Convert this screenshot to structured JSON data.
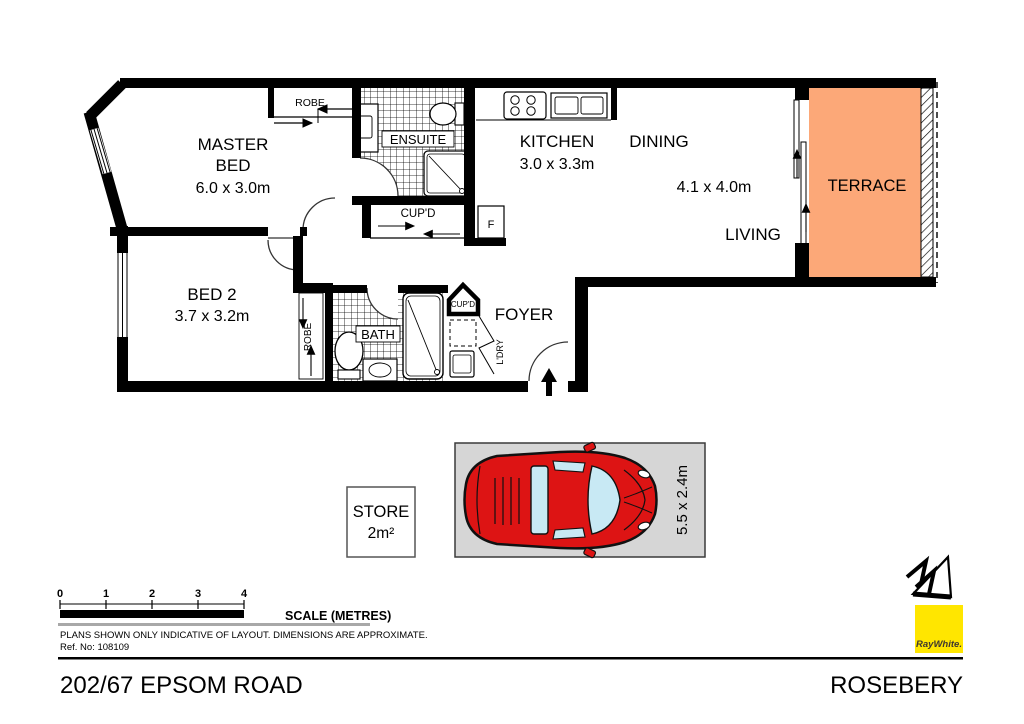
{
  "colors": {
    "terrace": "#FCA878",
    "car_body": "#DD1414",
    "car_glass": "#C8E9F4",
    "car_space_bg": "#D6D6D6",
    "brand_yellow": "#FFE600",
    "scale_gray": "#A8A8A8"
  },
  "floorplan": {
    "rooms": {
      "master_bed": {
        "line1": "MASTER",
        "line2": "BED",
        "dims": "6.0 x 3.0m"
      },
      "bed2": {
        "name": "BED 2",
        "dims": "3.7 x 3.2m"
      },
      "kitchen": {
        "name": "KITCHEN",
        "dims": "3.0 x 3.3m"
      },
      "dining": {
        "name": "DINING"
      },
      "living": {
        "name": "LIVING"
      },
      "living_dining_dims": "4.1 x 4.0m",
      "terrace": {
        "name": "TERRACE"
      },
      "foyer": {
        "name": "FOYER"
      },
      "ensuite": {
        "name": "ENSUITE"
      },
      "bath": {
        "name": "BATH"
      },
      "robe_master": "ROBE",
      "robe_bed2": "ROBE",
      "cupd_hall": "CUP'D",
      "cupd_foyer": "CUP'D",
      "laundry": "L'DRY",
      "fridge": "F"
    },
    "store": {
      "line1": "STORE",
      "line2": "2m²"
    },
    "car_space": {
      "dims": "5.5 x 2.4m"
    }
  },
  "scale_bar": {
    "ticks": [
      "0",
      "1",
      "2",
      "3",
      "4"
    ],
    "label": "SCALE (METRES)"
  },
  "notes": {
    "disclaimer": "PLANS SHOWN ONLY INDICATIVE OF LAYOUT.  DIMENSIONS ARE APPROXIMATE.",
    "ref": "Ref. No: 108109"
  },
  "footer": {
    "address": "202/67 EPSOM ROAD",
    "suburb": "ROSEBERY"
  },
  "brand": {
    "name": "RayWhite."
  }
}
